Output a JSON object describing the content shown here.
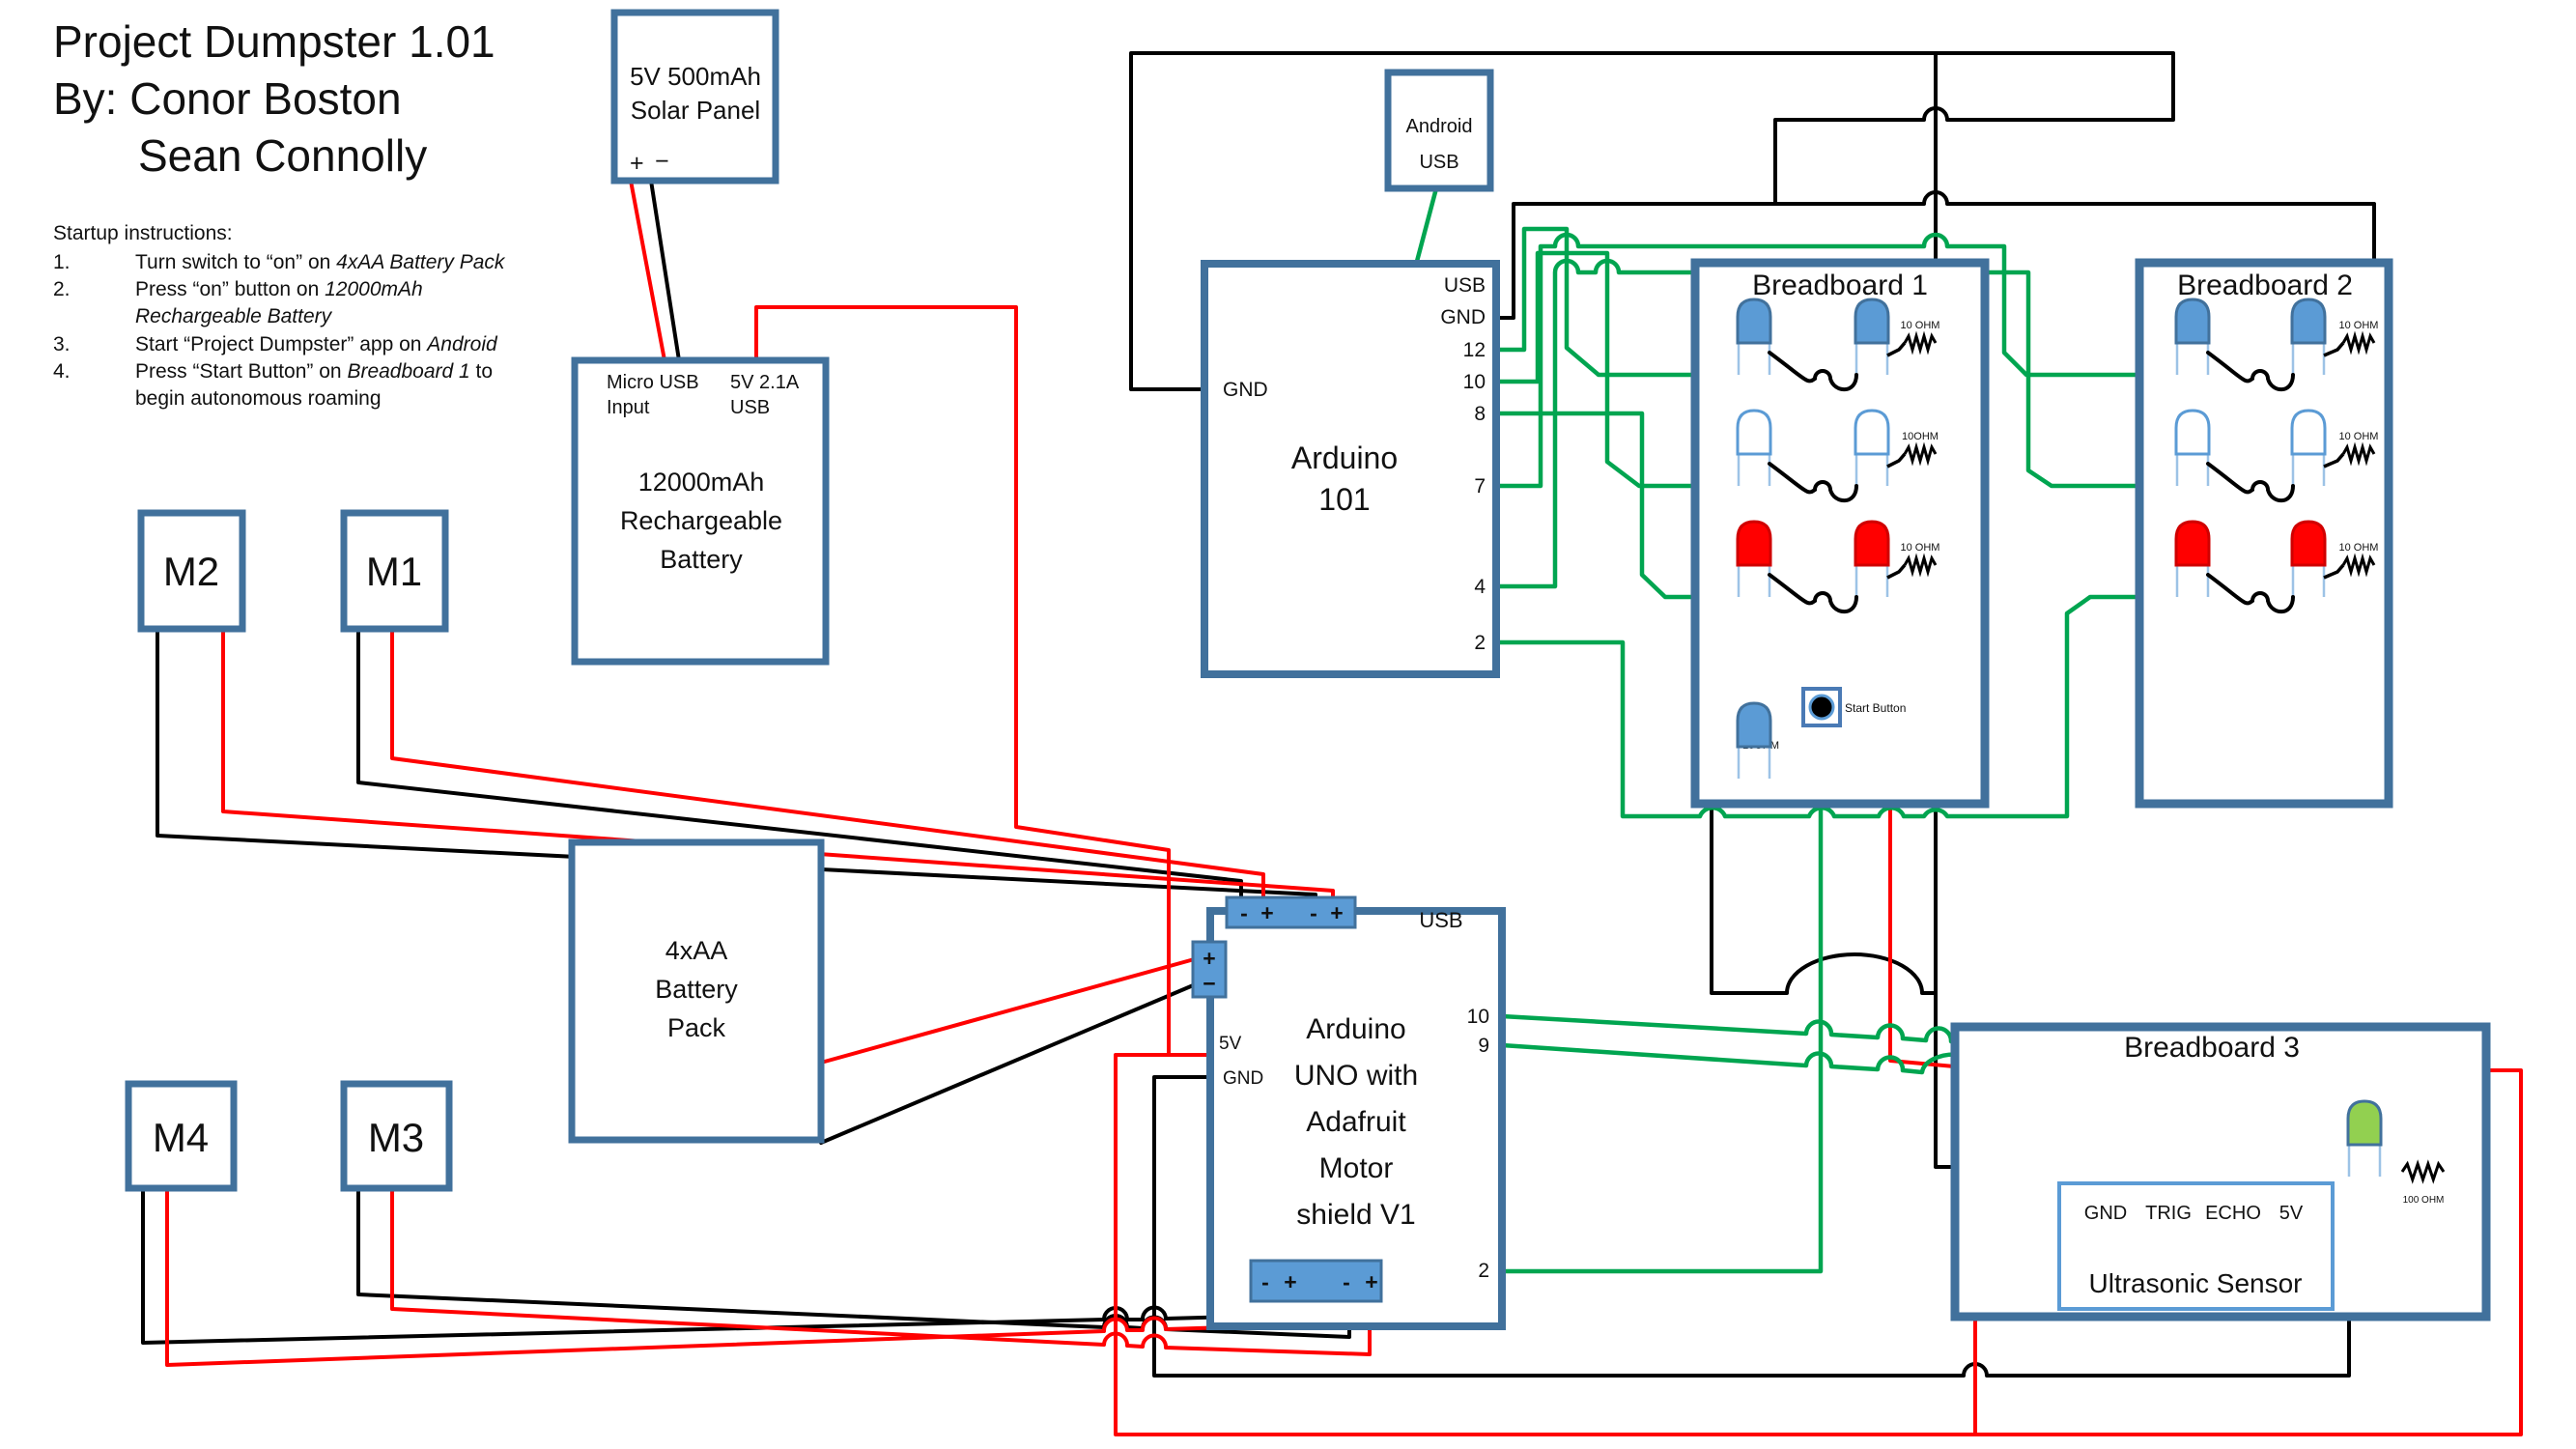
{
  "header": {
    "title": "Project Dumpster 1.01",
    "byline": "By: Conor Boston",
    "byline2": "Sean Connolly"
  },
  "instructions": {
    "heading": "Startup instructions:",
    "items": [
      {
        "n": "1.",
        "parts": [
          {
            "t": "Turn switch to “on” on "
          },
          {
            "t": "4xAA Battery Pack",
            "i": true
          }
        ]
      },
      {
        "n": "2.",
        "parts": [
          {
            "t": "Press “on” button on "
          },
          {
            "t": "12000mAh",
            "i": true
          },
          {
            "br": true
          },
          {
            "t": "Rechargeable Battery",
            "i": true
          }
        ]
      },
      {
        "n": "3.",
        "parts": [
          {
            "t": "Start “Project Dumpster” app on "
          },
          {
            "t": "Android",
            "i": true
          }
        ]
      },
      {
        "n": "4.",
        "parts": [
          {
            "t": "Press “Start Button” on "
          },
          {
            "t": "Breadboard 1",
            "i": true
          },
          {
            "t": " to"
          },
          {
            "br": true
          },
          {
            "t": "begin autonomous roaming"
          }
        ]
      }
    ]
  },
  "solar_panel": {
    "line1": "5V 500mAh",
    "line2": "Solar Panel",
    "plus": "+",
    "minus": "−"
  },
  "battery": {
    "in1": "Micro USB",
    "in2": "Input",
    "out1": "5V 2.1A",
    "out2": "USB",
    "name1": "12000mAh",
    "name2": "Rechargeable",
    "name3": "Battery"
  },
  "battery_pack": {
    "line1": "4xAA",
    "line2": "Battery",
    "line3": "Pack"
  },
  "motors": {
    "m1": "M1",
    "m2": "M2",
    "m3": "M3",
    "m4": "M4"
  },
  "arduino101": {
    "name1": "Arduino",
    "name2": "101",
    "left_pin": "GND",
    "right_pins": [
      "USB",
      "GND",
      "12",
      "10",
      "8",
      "7",
      "4",
      "2"
    ]
  },
  "android": {
    "line1": "Android",
    "line2": "USB"
  },
  "uno": {
    "name": [
      "Arduino",
      "UNO with",
      "Adafruit",
      "Motor",
      "shield V1"
    ],
    "usb": "USB",
    "left_pin1": "5V",
    "left_pin2": "GND",
    "right_pins": [
      "10",
      "9",
      "2"
    ],
    "sign_minus": "-",
    "sign_plus": "+",
    "pack_plus": "+",
    "pack_minus": "−"
  },
  "breadboard1": {
    "title": "Breadboard 1",
    "rows": [
      {
        "type": "blue",
        "resistor": "10 OHM"
      },
      {
        "type": "outline",
        "resistor": "10OHM"
      },
      {
        "type": "red",
        "resistor": "10 OHM"
      }
    ],
    "extra": {
      "type": "blue",
      "resistor": "10OHM",
      "button": "Start Button"
    }
  },
  "breadboard2": {
    "title": "Breadboard 2",
    "rows": [
      {
        "type": "blue",
        "resistor": "10 OHM"
      },
      {
        "type": "outline",
        "resistor": "10 OHM"
      },
      {
        "type": "red",
        "resistor": "10 OHM"
      }
    ]
  },
  "breadboard3": {
    "title": "Breadboard 3",
    "led_resistor": "100 OHM",
    "sensor": {
      "pins": [
        "GND",
        "TRIG",
        "ECHO",
        "5V"
      ],
      "name": "Ultrasonic Sensor"
    }
  },
  "colors": {
    "box_border": "#41719c",
    "led_blue": "#5b9bd5",
    "led_red": "#ff0000",
    "led_green": "#92d050",
    "wire_green": "#00a550",
    "wire_red": "#ff0000",
    "wire_black": "#000000",
    "lead": "#9dc3e6"
  }
}
